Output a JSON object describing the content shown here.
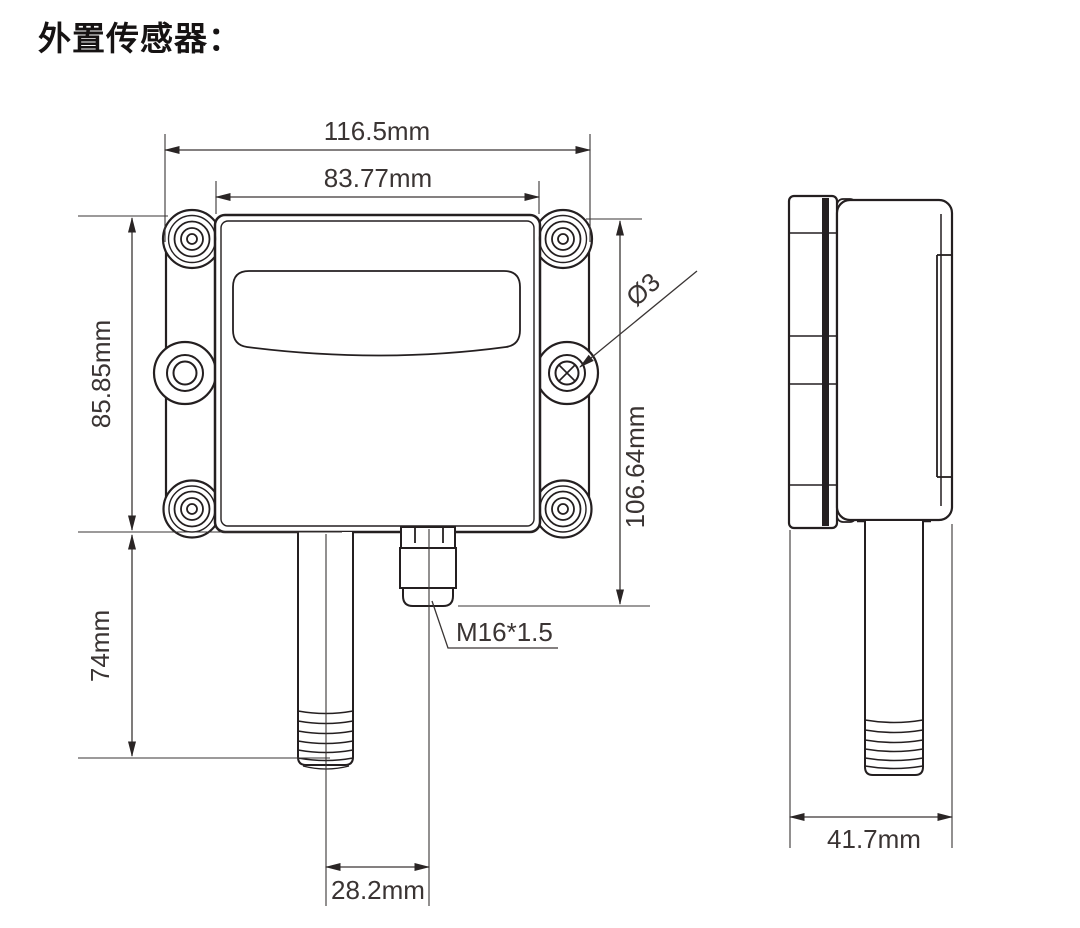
{
  "title": "外置传感器：",
  "views": {
    "front": "front view",
    "side": "side view"
  },
  "dimensions": {
    "overall_width": "116.5mm",
    "mount_width": "83.77mm",
    "body_height": "85.85mm",
    "probe_length": "74mm",
    "overall_height": "106.64mm",
    "hole_diameter": "Ø3",
    "gland_thread": "M16*1.5",
    "probe_offset": "28.2mm",
    "depth": "41.7mm"
  },
  "colors": {
    "line": "#241f20",
    "dimension": "#3a3534",
    "text": "#3a3433",
    "title": "#161313",
    "background": "#ffffff"
  }
}
